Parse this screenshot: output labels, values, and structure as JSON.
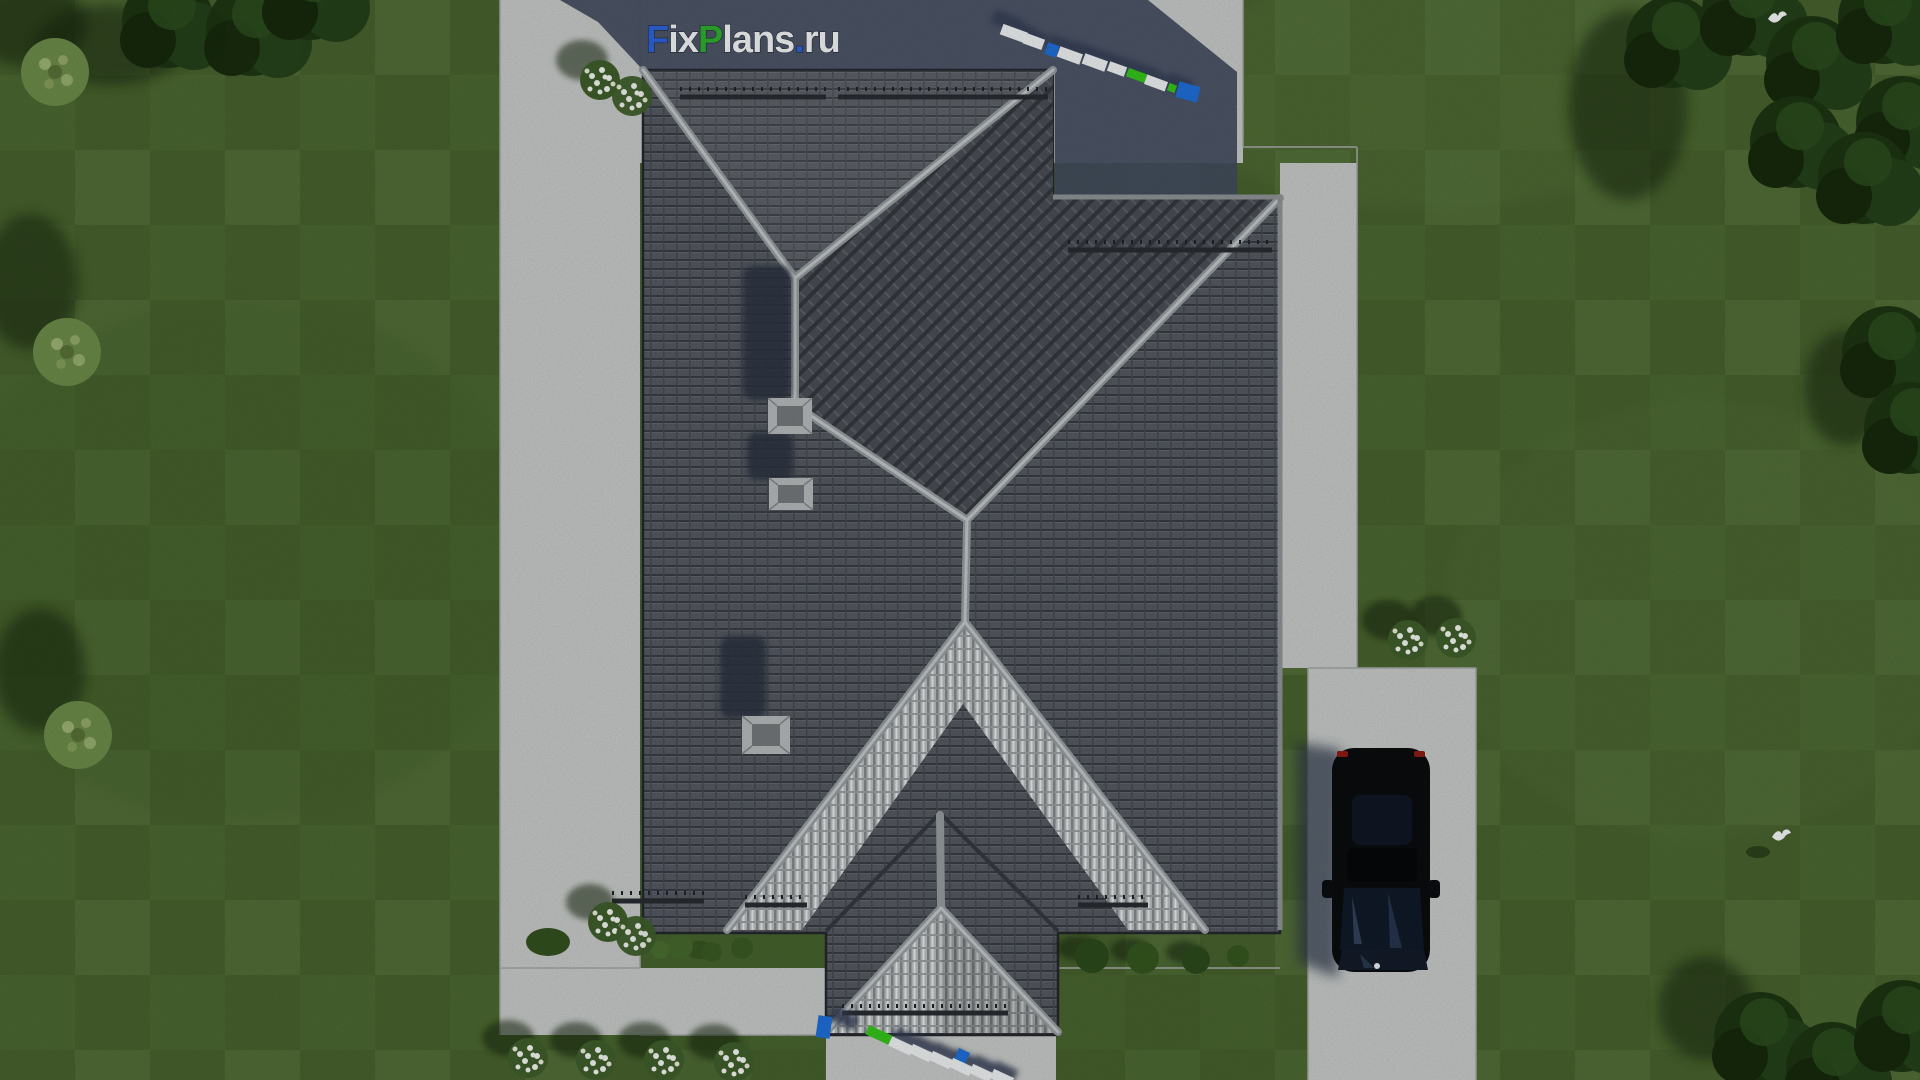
{
  "meta": {
    "title": "Aerial top-down 3D render of a hip-roof house plan"
  },
  "watermark": {
    "text": "FixPlans.ru",
    "parts": [
      {
        "t": "F",
        "c": "#2e63d8"
      },
      {
        "t": "ix",
        "c": "#f2f4f6"
      },
      {
        "t": "P",
        "c": "#2fae2f"
      },
      {
        "t": "lans",
        "c": "#f2f4f6"
      },
      {
        "t": ".",
        "c": "#2e63d8"
      },
      {
        "t": "ru",
        "c": "#f2f4f6"
      }
    ]
  },
  "colors": {
    "grass": "#4c6831",
    "grass_light": "#5b7a40",
    "garden_bed": "#47632d",
    "concrete": "#c7cac8",
    "concrete_edge": "#a4a8a6",
    "building_shadow": "#424c5f",
    "roof_dark": "#555a61",
    "roof_ridge": "#a9aeb1",
    "roof_bright": "#bfc3c4",
    "tree_dark": "#1d3512",
    "bush_light": "#6d8c49",
    "flower_white": "#f3f5ef",
    "car_body": "#0b0c0e",
    "car_glass": "#101a29",
    "taillight_red": "#8f1a14",
    "sign_blue": "#1f6fd8",
    "sign_green": "#35c41c",
    "sign_white": "#eef1f2",
    "bird_white": "#f4f6f8"
  },
  "labels": {
    "house": "hip-roof-house",
    "porch": "entrance-porch",
    "car": "black-car",
    "driveway": "driveway",
    "sign_top": "fixplans-3d-sign",
    "sign_bottom": "fixplans-3d-sign",
    "birds": "white-birds"
  }
}
